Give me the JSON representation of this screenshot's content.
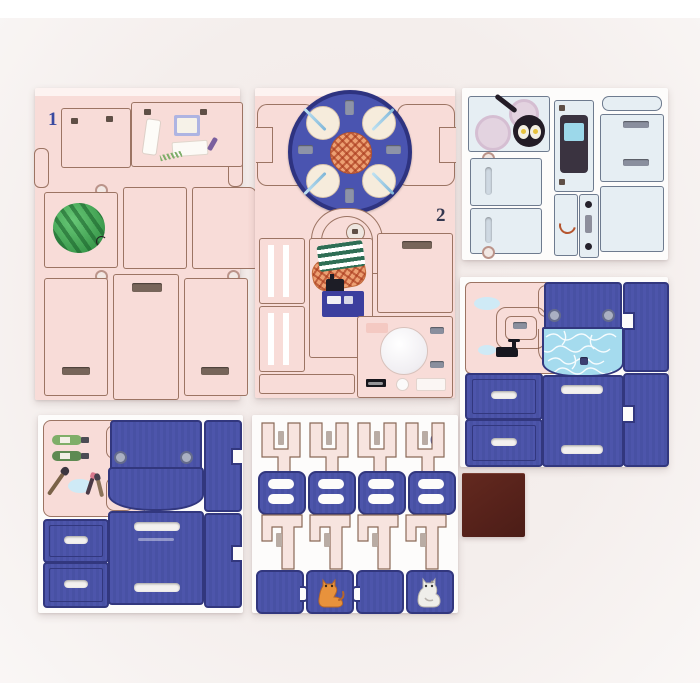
{
  "photo": {
    "sheets": [
      {
        "id": "sheet-1",
        "number": "1"
      },
      {
        "id": "sheet-2",
        "number": "2"
      },
      {
        "id": "sheet-3",
        "number": "3"
      },
      {
        "id": "sheet-4",
        "number": "4"
      },
      {
        "id": "sheet-5",
        "number": "5"
      },
      {
        "id": "sheet-6",
        "number": "6"
      },
      {
        "id": "sheet-7",
        "number": "7"
      }
    ],
    "colors": {
      "sheet_pink": "#f8dcd8",
      "sheet_white": "#fdfcfb",
      "sheet_blue_tint": "#e6eef3",
      "piece_blue": "#4d55ab",
      "piece_blue_border": "#32377e",
      "table_blue": "#4a54b0",
      "water_blue": "#a5dbee",
      "brown_square": "#5a241d",
      "outline_brown": "#855a46",
      "number_blue": "#3a4aa0",
      "number_dark": "#33374f",
      "watermelon_green": "#46a858",
      "cat_orange": "#e8923c",
      "cat_white": "#eceae6"
    }
  }
}
